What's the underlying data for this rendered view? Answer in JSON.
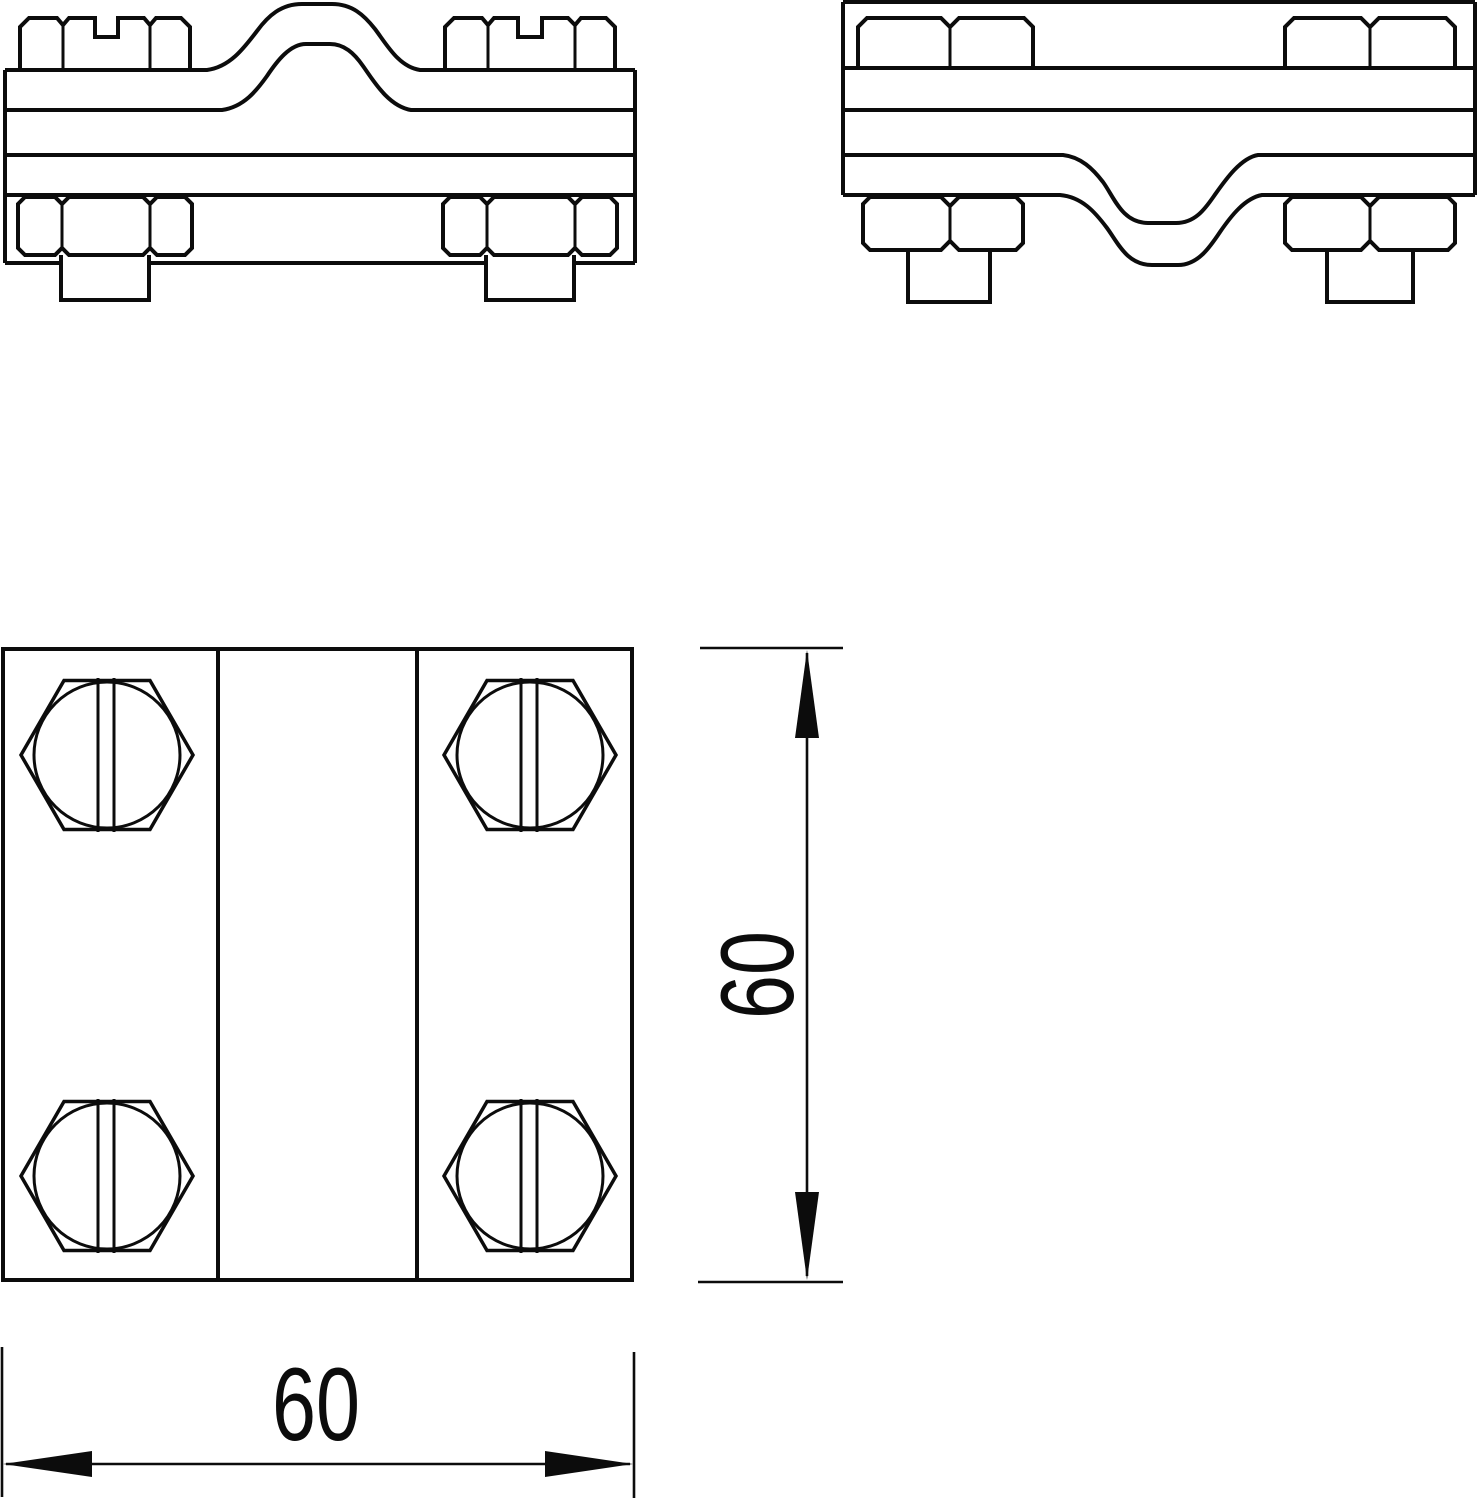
{
  "drawing": {
    "background": "#ffffff",
    "line_color": "#0c0c0c",
    "dimensions": {
      "horizontal": {
        "label": "60"
      },
      "vertical": {
        "label": "60"
      }
    }
  }
}
